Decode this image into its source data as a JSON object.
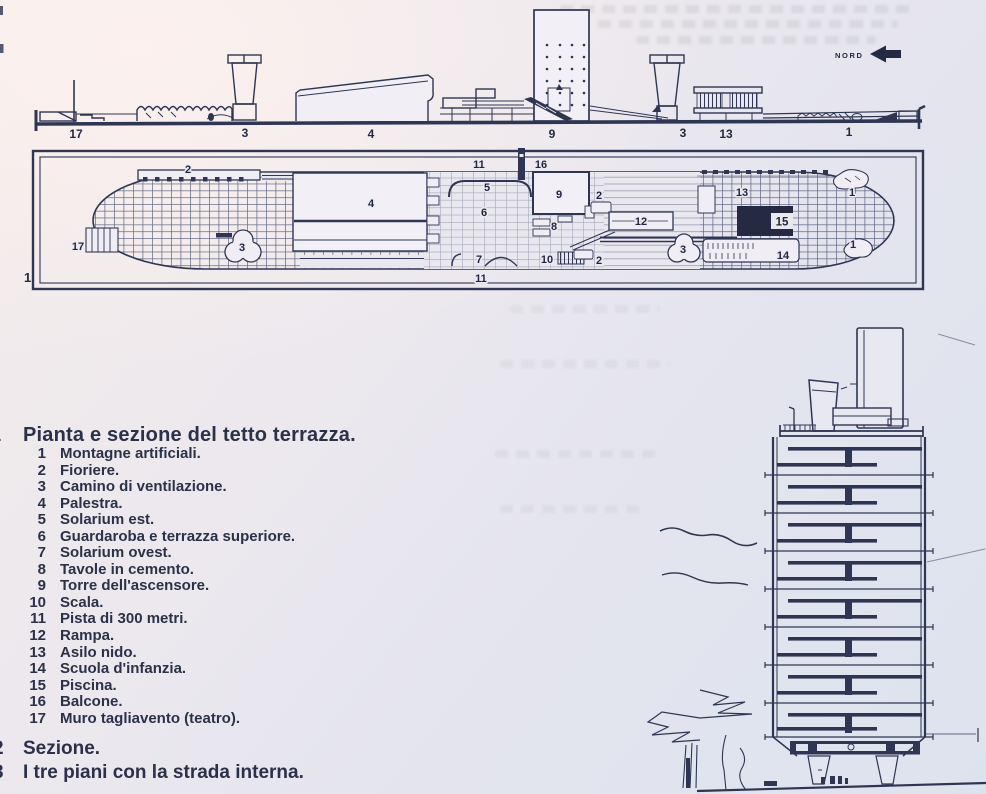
{
  "compass": {
    "label": "NORD"
  },
  "figures": {
    "plan_number": "1",
    "caption_1_number": "1",
    "caption_2_number": "2",
    "caption_3_number": "3"
  },
  "section_labels": {
    "wall": "17",
    "chimney_a": "3",
    "gym": "4",
    "tower": "9",
    "chimney_b": "3",
    "nursery": "13",
    "mountains": "1"
  },
  "plan_labels": {
    "fioriere_top": "2",
    "wall": "17",
    "chimney_left": "3",
    "gym": "4",
    "track_top": "11",
    "solarium_est": "5",
    "balcony": "16",
    "wardrobe": "6",
    "tower": "9",
    "tables": "8",
    "planter_upper": "2",
    "ramp": "12",
    "stairs": "10",
    "solarium_ovest": "7",
    "planter_lower": "2",
    "track_bottom": "11",
    "nursery": "13",
    "pool": "15",
    "chimney_right": "3",
    "school": "14",
    "mountain_upper": "1",
    "mountain_lower": "1"
  },
  "legend": {
    "title": "Pianta e sezione del tetto terrazza.",
    "items": [
      {
        "num": "1",
        "text": "Montagne artificiali."
      },
      {
        "num": "2",
        "text": "Fioriere."
      },
      {
        "num": "3",
        "text": "Camino di ventilazione."
      },
      {
        "num": "4",
        "text": "Palestra."
      },
      {
        "num": "5",
        "text": "Solarium est."
      },
      {
        "num": "6",
        "text": "Guardaroba e terrazza superiore."
      },
      {
        "num": "7",
        "text": "Solarium ovest."
      },
      {
        "num": "8",
        "text": "Tavole in cemento."
      },
      {
        "num": "9",
        "text": "Torre dell'ascensore."
      },
      {
        "num": "10",
        "text": "Scala."
      },
      {
        "num": "11",
        "text": "Pista di 300 metri."
      },
      {
        "num": "12",
        "text": "Rampa."
      },
      {
        "num": "13",
        "text": "Asilo nido."
      },
      {
        "num": "14",
        "text": "Scuola d'infanzia."
      },
      {
        "num": "15",
        "text": "Piscina."
      },
      {
        "num": "16",
        "text": "Balcone."
      },
      {
        "num": "17",
        "text": "Muro tagliavento (teatro)."
      }
    ]
  },
  "captions": {
    "sezione": "Sezione.",
    "tre_piani": "I tre piani con la strada interna."
  },
  "colors": {
    "ink": "#2f3653",
    "paper": "#ece9f0",
    "pool_fill": "#232a42"
  }
}
